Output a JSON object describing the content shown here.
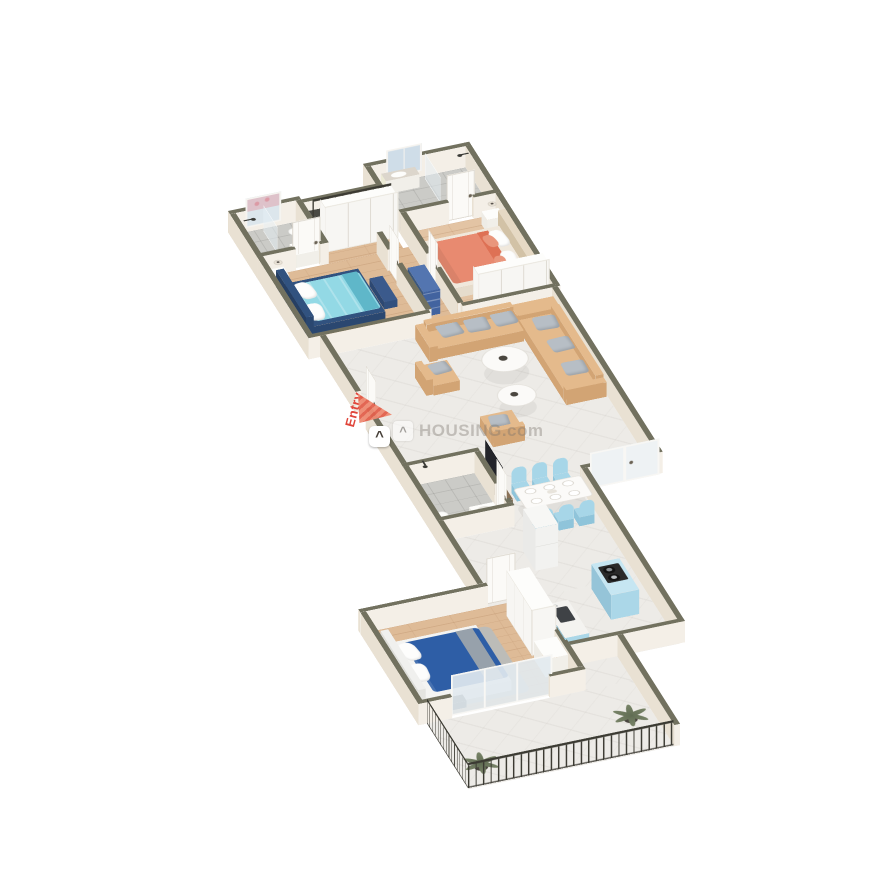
{
  "overlay": {
    "entry_label": "Entry",
    "watermark_text": "HOUSING.com",
    "watermark_icon_glyph": "^"
  },
  "colors": {
    "background": "#ffffff",
    "wallTop": "#72715f",
    "wallTopDark": "#666555",
    "wallFace": "#f4efe7",
    "wallFaceW": "#e9e1d3",
    "wood": "#debb97",
    "woodB": "#e3c4a4",
    "woodLine": "rgba(160,110,70,0.28)",
    "tile": "#cccc c8",
    "tileA": "#cbcbc7",
    "tileLine": "rgba(0,0,0,0.09)",
    "marble": "#edebe7",
    "marbleVein": "rgba(180,175,168,0.18)",
    "balcony": "#eceae5",
    "glass": "rgba(230,240,245,0.5)",
    "door": "#fbfaf7",
    "doorLine": "#d9d4ca",
    "handle": "#6b6355",
    "wardrobe": "#f7f6f3",
    "seam": "#dedad2",
    "railing": "#3b3a32",
    "sofa": "#e4ba8c",
    "sofaDark": "#d2a474",
    "cushion": "#b7bec5",
    "white": "#fbfaf8",
    "chairBlue": "#a7d6e8",
    "chairDark": "#8fc4da",
    "bedACyan": "#93d9e5",
    "bedAFrame": "#31527f",
    "bedAThrow": "#5fb7c9",
    "bedBSalmon": "#e88a70",
    "bedBDark": "#de7155",
    "bedCNavy": "#2e5ea6",
    "rug": "#bcbcb8",
    "dresserBlue": "#42639f",
    "kitchenBlue": "#abd7e8",
    "kitchenBlueTop": "#c6e6f2",
    "cooktop": "#2a2a2a",
    "fridge": "#f2f2f0",
    "tv": "#23242a",
    "console": "#8a7258",
    "plant1": "#5f6b52",
    "plant2": "#798468",
    "pot": "#4a463f",
    "entryRed": "#e0453a",
    "arrowSalmon": "#ee8a72",
    "arrowStripe": "#e2604c",
    "watermarkGray": "rgba(120,115,108,0.38)"
  }
}
